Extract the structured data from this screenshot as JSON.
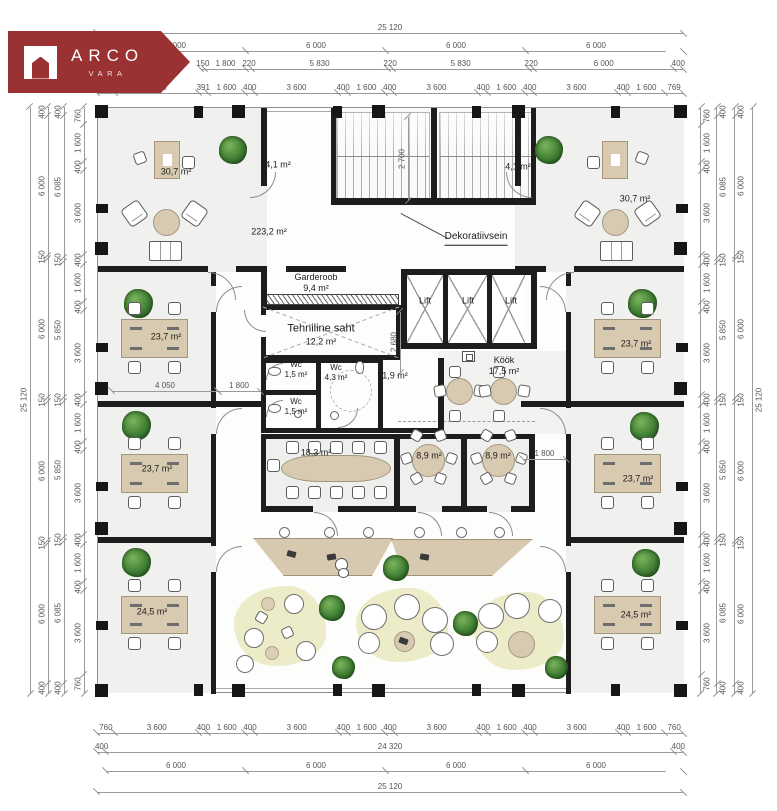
{
  "logo": {
    "title": "ARCO",
    "subtitle": "VARA"
  },
  "colors": {
    "logo_red": "#9a3132",
    "wall": "#1d1d1d",
    "furniture_tan": "#d8cab1",
    "zone_green": "#ecedc8",
    "plant_green": "#3f7d33",
    "dim_gray": "#9a9a9a"
  },
  "rooms": {
    "office_top_left": {
      "area": "30,7 m²"
    },
    "office_top_right": {
      "area": "30,7 m²"
    },
    "stair_left": {
      "area": "4,1 m²"
    },
    "stair_right": {
      "area": "4,1 m²"
    },
    "open_office": {
      "area": "223,2 m²"
    },
    "decorative_wall": {
      "label": "Dekoratiivsein"
    },
    "garderoob": {
      "name": "Garderoob",
      "area": "9,4 m²"
    },
    "tech_shaft": {
      "name": "Tehniline saht",
      "area": "12,2 m²"
    },
    "lift_1": {
      "name": "Lift"
    },
    "lift_2": {
      "name": "Lift"
    },
    "lift_3": {
      "name": "Lift"
    },
    "wc_1": {
      "name": "Wc",
      "area": "1,5 m²"
    },
    "wc_2": {
      "name": "Wc",
      "area": "1,5 m²"
    },
    "wc_3": {
      "name": "Wc",
      "area": "4,3 m²"
    },
    "hall": {
      "area": "1,9 m²"
    },
    "kitchen": {
      "name": "Köök",
      "area": "17,5 m²"
    },
    "meeting_large": {
      "area": "18,3 m²"
    },
    "meeting_small_1": {
      "area": "8,9 m²"
    },
    "meeting_small_2": {
      "area": "8,9 m²"
    },
    "office_left_1": {
      "area": "23,7 m²"
    },
    "office_left_2": {
      "area": "23,7 m²"
    },
    "office_right_1": {
      "area": "23,7 m²"
    },
    "office_right_2": {
      "area": "23,7 m²"
    },
    "office_bottom_left": {
      "area": "24,5 m²"
    },
    "office_bottom_right": {
      "area": "24,5 m²"
    }
  },
  "dims": {
    "top": {
      "overall": [
        "25 120"
      ],
      "axes": [
        "6 000",
        "6 000",
        "6 000",
        "6 000"
      ],
      "rooms": [
        "150",
        "1 800",
        "220",
        "5 830",
        "220",
        "5 830",
        "220",
        "6 000",
        "400"
      ],
      "detail": [
        "760",
        "3 600",
        "391",
        "1 600",
        "400",
        "3 600",
        "400",
        "1 600",
        "400",
        "3 600",
        "400",
        "1 600",
        "400",
        "3 600",
        "400",
        "1 600",
        "769"
      ]
    },
    "bottom": {
      "detail": [
        "760",
        "3 600",
        "400",
        "1 600",
        "400",
        "3 600",
        "400",
        "1 600",
        "400",
        "3 600",
        "400",
        "1 600",
        "400",
        "3 600",
        "400",
        "1 600",
        "760"
      ],
      "inner": [
        "400",
        "24 320",
        "400"
      ],
      "axes": [
        "6 000",
        "6 000",
        "6 000",
        "6 000"
      ],
      "overall": [
        "25 120"
      ]
    },
    "left": {
      "overall": [
        "25 120"
      ],
      "axes": [
        "400",
        "6 000",
        "150",
        "6 000",
        "150",
        "6 000",
        "150",
        "6 000",
        "400"
      ],
      "rooms": [
        "400",
        "6 085",
        "150",
        "5 850",
        "150",
        "5 850",
        "150",
        "6 085",
        "400"
      ],
      "detail": [
        "760",
        "1 600",
        "400",
        "3 600",
        "400",
        "1 600",
        "400",
        "3 600",
        "400",
        "1 600",
        "400",
        "3 600",
        "400",
        "1 600",
        "400",
        "3 600",
        "760"
      ]
    },
    "right": {
      "detail": [
        "760",
        "1 600",
        "400",
        "3 600",
        "400",
        "1 600",
        "400",
        "3 600",
        "400",
        "1 600",
        "400",
        "3 600",
        "400",
        "1 600",
        "400",
        "3 600",
        "760"
      ],
      "rooms": [
        "400",
        "6 085",
        "150",
        "5 850",
        "150",
        "5 850",
        "150",
        "6 085",
        "400"
      ],
      "axes": [
        "400",
        "6 000",
        "150",
        "6 000",
        "150",
        "6 000",
        "150",
        "6 000",
        "400"
      ],
      "overall": [
        "25 120"
      ]
    },
    "interior": {
      "stair_depth": "2 700",
      "lobby_depth": "2 680",
      "room_width": "4 050",
      "corridor_left": "1 800",
      "corridor_right": "1 800"
    }
  }
}
